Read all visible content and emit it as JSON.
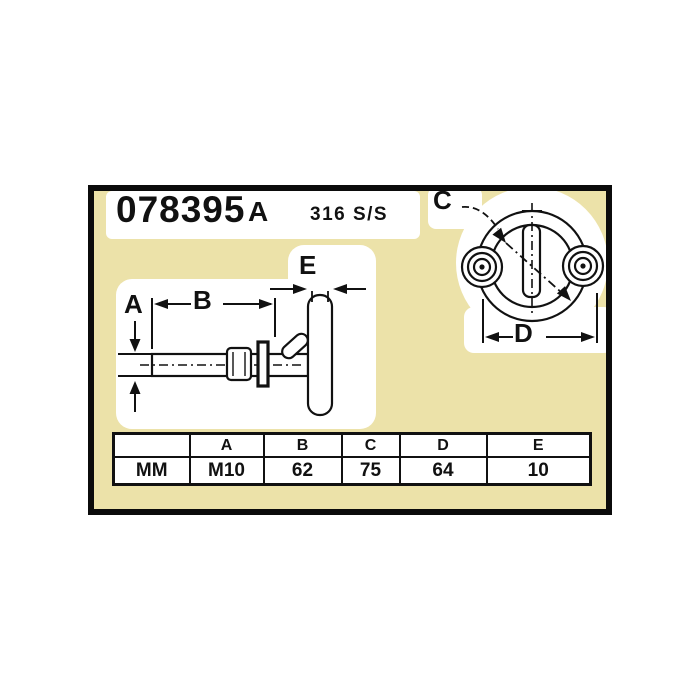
{
  "header": {
    "part_number": "078395",
    "variant": "A",
    "material": "316 S/S"
  },
  "drawing": {
    "labels": {
      "a": "A",
      "b": "B",
      "c": "C",
      "d": "D",
      "e": "E"
    },
    "views": [
      "side-view-t-bolt",
      "front-view-ring"
    ]
  },
  "spec_table": {
    "headers": [
      "",
      "A",
      "B",
      "C",
      "D",
      "E"
    ],
    "unit_row": [
      "MM",
      "M10",
      "62",
      "75",
      "64",
      "10"
    ]
  },
  "colors": {
    "panel_background": "#ece2a9",
    "line": "#111111",
    "paper_patch": "#ffffff",
    "page_background": "#ffffff"
  }
}
